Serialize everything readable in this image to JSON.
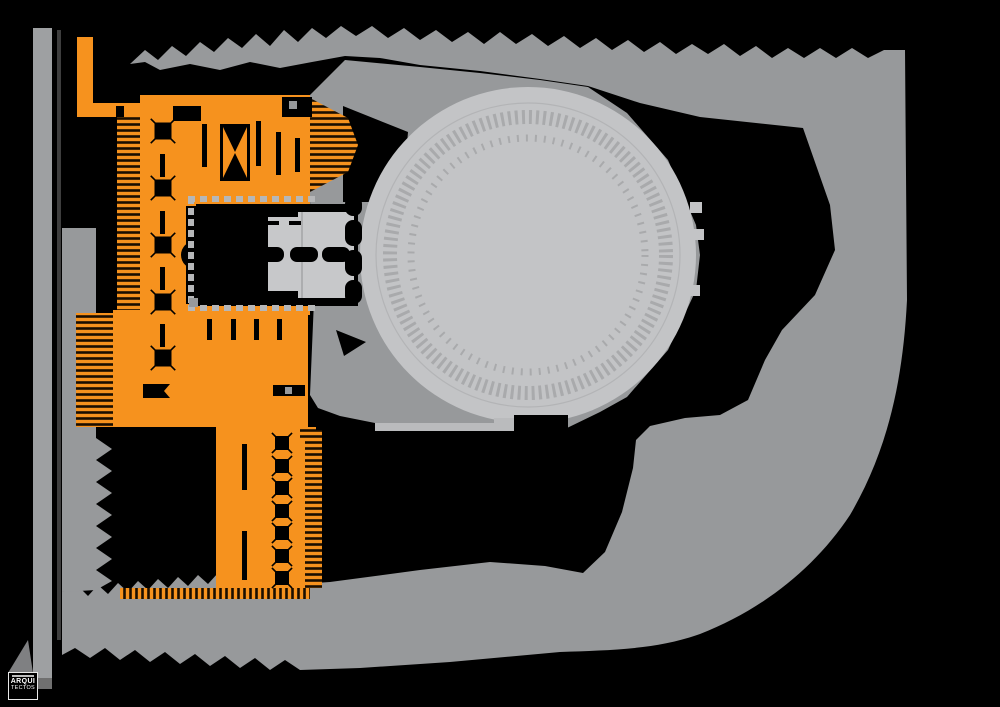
{
  "meta": {
    "drawing_type": "architectural-site-plan",
    "canvas": {
      "width": 1000,
      "height": 707
    }
  },
  "palette": {
    "background": "#000000",
    "plaza_gray": "#97999B",
    "road_gray": "#9EA0A2",
    "arena_light_gray": "#C3C4C6",
    "arena_detail_gray": "#A9AAAC",
    "hall_light_gray": "#C7C8CA",
    "walkway_light": "#BABBBD",
    "dash_gray": "#B6B7B9",
    "building_orange": "#F6921E",
    "ink_black": "#000000"
  },
  "logo": {
    "line1": "ARQUI",
    "line2": "TECTOS"
  },
  "regions": [
    {
      "name": "highlighted-building",
      "color": "#F6921E"
    },
    {
      "name": "circular-arena",
      "color": "#C3C4C6"
    },
    {
      "name": "public-plaza",
      "color": "#97999B"
    },
    {
      "name": "west-road",
      "color": "#9EA0A2"
    },
    {
      "name": "void",
      "color": "#000000"
    }
  ],
  "plan": {
    "shapes": [
      {
        "name": "background",
        "type": "rect",
        "x": 0,
        "y": 0,
        "w": 1000,
        "h": 707,
        "fill": "#000000"
      },
      {
        "name": "road-west",
        "type": "rect",
        "x": 33,
        "y": 28,
        "w": 19,
        "h": 650,
        "fill": "#9EA0A2"
      },
      {
        "name": "road-divider",
        "type": "rect",
        "x": 57,
        "y": 30,
        "w": 4,
        "h": 610,
        "fill": "#3E3E3E"
      },
      {
        "name": "road-end-cap",
        "type": "polygon",
        "points": "33,678 52,678 52,689 38,689",
        "fill": "#707070"
      },
      {
        "name": "plaza-band",
        "type": "path",
        "fill": "#97999B",
        "d": "M130,64 L145,50 L158,60 L172,46 L186,56 L200,42 L214,52 L228,38 L242,48 L256,34 L270,46 L284,30 L298,42 L312,28 L326,38 L341,26 L356,36 L372,26 L388,38 L404,28 L420,40 L436,30 L452,42 L468,32 L484,44 L500,32 L516,44 L532,34 L548,46 L564,36 L580,48 L596,38 L612,50 L628,40 L644,52 L660,42 L676,54 L692,44 L708,54 L724,44 L740,56 L756,46 L772,58 L788,48 L804,58 L820,48 L836,58 L852,48 L868,58 L884,50 L905,50 L907,300 C903,380 888,450 850,515 C815,568 762,610 700,634 C655,650 610,650 560,652 L450,662 L360,668 L300,670 L285,660 L270,670 L255,658 L240,668 L225,656 L210,666 L195,654 L180,664 L165,652 L150,662 L135,650 L120,660 L105,648 L90,658 L75,648 L62,655 L62,592 L80,588 L88,596 L98,585 L108,594 L118,583 L128,592 L138,581 L148,590 L158,579 L168,588 L178,577 L188,586 L198,575 L208,584 L218,573 L228,582 L238,571 L248,580 L258,569 L268,578 L278,569 L290,578 L300,584 L330,582 L420,570 L490,562 L545,566 L583,573 L605,552 L622,512 L633,468 L636,440 L650,426 L685,418 L720,415 L748,400 L765,360 L782,330 L815,295 L835,250 L830,205 L803,128 L700,117 L640,103 L588,86 L540,79 L480,71 L420,65 L380,58 L345,56 L312,62 L280,68 L250,62 L220,70 L190,64 L160,70 L145,62 Z"
      },
      {
        "name": "west-terrace-column",
        "type": "path",
        "fill": "#97999B",
        "d": "M62,228 L96,228 L96,438 L112,449 L96,460 L112,471 L96,482 L112,493 L96,504 L112,515 L96,526 L112,537 L96,548 L112,559 L96,570 L112,581 L96,590 L62,592 Z"
      },
      {
        "name": "arena-surround-plaza",
        "type": "path",
        "fill": "#97999B",
        "d": "M310,95 L345,60 L420,67 L480,73 L540,80 L588,87 L627,113 L668,160 L696,225 L700,255 L696,290 L668,350 L627,397 L600,412 L567,428 L513,428 L430,426 L380,424 L340,416 L318,408 L310,395 L314,300 L310,200 Z"
      },
      {
        "name": "south-walkway-strip",
        "type": "rect",
        "x": 375,
        "y": 423,
        "w": 140,
        "h": 8,
        "fill": "#BABBBD"
      },
      {
        "name": "void-wedge-west-of-arena",
        "type": "polygon",
        "points": "343,106 408,132 402,202 343,202",
        "fill": "#000000"
      },
      {
        "name": "circular-arena",
        "type": "circle",
        "cx": 528,
        "cy": 255,
        "r": 168,
        "fill": "#C3C4C6"
      },
      {
        "name": "arena-edge-ring",
        "type": "ring",
        "cx": 528,
        "cy": 255,
        "r": 152,
        "stroke": "#B3B4B6",
        "sw": 1.2,
        "dash": ""
      },
      {
        "name": "arena-seating-ring",
        "type": "ring",
        "cx": 528,
        "cy": 255,
        "r": 138,
        "stroke": "#A9AAAC",
        "sw": 14,
        "dash": "3 4"
      },
      {
        "name": "arena-inner-ring",
        "type": "ring",
        "cx": 528,
        "cy": 255,
        "r": 117,
        "stroke": "#A9AAAC",
        "sw": 7,
        "dash": "2 7"
      },
      {
        "name": "arena-east-nub-1",
        "type": "rect",
        "x": 690,
        "y": 202,
        "w": 12,
        "h": 11,
        "fill": "#C3C4C6"
      },
      {
        "name": "arena-east-nub-2",
        "type": "rect",
        "x": 692,
        "y": 229,
        "w": 12,
        "h": 11,
        "fill": "#C3C4C6"
      },
      {
        "name": "arena-east-nub-3",
        "type": "rect",
        "x": 688,
        "y": 285,
        "w": 12,
        "h": 11,
        "fill": "#C3C4C6"
      },
      {
        "name": "south-stage-block",
        "type": "rect",
        "x": 514,
        "y": 415,
        "w": 54,
        "h": 22,
        "fill": "#000000"
      },
      {
        "name": "south-stage-link",
        "type": "rect",
        "x": 494,
        "y": 418,
        "w": 20,
        "h": 7,
        "fill": "#BABBBD"
      },
      {
        "name": "building-nw-vertical-strip",
        "type": "rect",
        "x": 77,
        "y": 37,
        "w": 16,
        "h": 70,
        "fill": "#F6921E"
      },
      {
        "name": "building-nw-horizontal-strip",
        "type": "rect",
        "x": 77,
        "y": 103,
        "w": 83,
        "h": 14,
        "fill": "#F6921E"
      },
      {
        "name": "building-nw-notch",
        "type": "rect",
        "x": 116,
        "y": 106,
        "w": 8,
        "h": 11,
        "fill": "#000000"
      },
      {
        "name": "building-top-bar",
        "type": "rect",
        "x": 140,
        "y": 95,
        "w": 170,
        "h": 100,
        "fill": "#F6921E"
      },
      {
        "name": "building-spine",
        "type": "rect",
        "x": 140,
        "y": 95,
        "w": 46,
        "h": 332,
        "fill": "#F6921E"
      },
      {
        "name": "building-middle-bar",
        "type": "rect",
        "x": 113,
        "y": 310,
        "w": 195,
        "h": 117,
        "fill": "#F6921E"
      },
      {
        "name": "building-south-wing",
        "type": "rect",
        "x": 216,
        "y": 427,
        "w": 92,
        "h": 168,
        "fill": "#F6921E"
      },
      {
        "name": "courtyard-border-top",
        "type": "rect",
        "x": 186,
        "y": 195,
        "w": 124,
        "h": 11,
        "fill": "#F6921E"
      },
      {
        "name": "courtyard-border-bottom",
        "type": "rect",
        "x": 186,
        "y": 304,
        "w": 124,
        "h": 11,
        "fill": "#F6921E"
      },
      {
        "name": "hatch-spine-west",
        "type": "rect",
        "x": 117,
        "y": 117,
        "w": 23,
        "h": 193,
        "fill": "hatchH"
      },
      {
        "name": "hatch-terraces-west",
        "type": "rect",
        "x": 76,
        "y": 313,
        "w": 37,
        "h": 114,
        "fill": "hatchH"
      },
      {
        "name": "hatch-topbar-arrow",
        "type": "polygon",
        "points": "310,98 348,118 358,145 348,172 310,192",
        "fill": "hatchH"
      },
      {
        "name": "hatch-wing-east",
        "type": "rect",
        "x": 305,
        "y": 430,
        "w": 17,
        "h": 158,
        "fill": "hatchH"
      },
      {
        "name": "hatch-wing-south-fringe",
        "type": "rect",
        "x": 120,
        "y": 588,
        "w": 190,
        "h": 11,
        "fill": "hatchV"
      },
      {
        "name": "hatch-midbar-corner",
        "type": "rect",
        "x": 300,
        "y": 427,
        "w": 16,
        "h": 13,
        "fill": "hatchH"
      },
      {
        "name": "topbar-north-notch",
        "type": "rect",
        "x": 173,
        "y": 106,
        "w": 28,
        "h": 15,
        "fill": "#000000"
      },
      {
        "name": "topbar-north-block",
        "type": "rect",
        "x": 282,
        "y": 97,
        "w": 30,
        "h": 20,
        "fill": "#000000"
      },
      {
        "name": "topbar-north-block-window",
        "type": "rect",
        "x": 289,
        "y": 101,
        "w": 8,
        "h": 8,
        "fill": "#97999B"
      },
      {
        "name": "stair-core-frame",
        "type": "rect",
        "x": 220,
        "y": 124,
        "w": 30,
        "h": 57,
        "fill": "#000000"
      },
      {
        "name": "stair-core-inner",
        "type": "rect",
        "x": 223,
        "y": 127,
        "w": 24,
        "h": 51,
        "fill": "#F6921E"
      },
      {
        "name": "stair-core-flight-up",
        "type": "polygon",
        "points": "223,127 247,127 235,152",
        "fill": "#000000"
      },
      {
        "name": "stair-core-flight-down",
        "type": "polygon",
        "points": "223,178 247,178 235,153",
        "fill": "#000000"
      },
      {
        "name": "topbar-wall-slot-1",
        "type": "rect",
        "x": 202,
        "y": 124,
        "w": 5,
        "h": 43,
        "fill": "#000000"
      },
      {
        "name": "topbar-wall-slot-2",
        "type": "rect",
        "x": 256,
        "y": 121,
        "w": 5,
        "h": 45,
        "fill": "#000000"
      },
      {
        "name": "topbar-wall-slot-3",
        "type": "rect",
        "x": 276,
        "y": 132,
        "w": 5,
        "h": 43,
        "fill": "#000000"
      },
      {
        "name": "topbar-wall-slot-4",
        "type": "rect",
        "x": 295,
        "y": 138,
        "w": 5,
        "h": 34,
        "fill": "#000000"
      },
      {
        "name": "spine-column-row",
        "type": "xcolumn",
        "cx": 163,
        "cys": [
          131,
          188,
          245,
          302,
          358
        ],
        "s": 17,
        "fill": "#000000"
      },
      {
        "name": "spine-wall-slot-1",
        "type": "rect",
        "x": 160,
        "y": 154,
        "w": 5,
        "h": 23,
        "fill": "#000000"
      },
      {
        "name": "spine-wall-slot-2",
        "type": "rect",
        "x": 160,
        "y": 211,
        "w": 5,
        "h": 23,
        "fill": "#000000"
      },
      {
        "name": "spine-wall-slot-3",
        "type": "rect",
        "x": 160,
        "y": 267,
        "w": 5,
        "h": 23,
        "fill": "#000000"
      },
      {
        "name": "spine-wall-slot-4",
        "type": "rect",
        "x": 160,
        "y": 324,
        "w": 5,
        "h": 23,
        "fill": "#000000"
      },
      {
        "name": "courtyard-hall-void",
        "type": "rect",
        "x": 196,
        "y": 204,
        "w": 162,
        "h": 102,
        "fill": "#000000"
      },
      {
        "name": "courtyard-west-apse",
        "type": "circle",
        "cx": 195,
        "cy": 255,
        "r": 14,
        "fill": "#000000"
      },
      {
        "name": "foyer-hall",
        "type": "rect",
        "x": 268,
        "y": 212,
        "w": 86,
        "h": 86,
        "fill": "#C7C8CA"
      },
      {
        "name": "foyer-north-bar",
        "type": "rect",
        "x": 268,
        "y": 208,
        "w": 30,
        "h": 9,
        "fill": "#000000"
      },
      {
        "name": "foyer-south-bar",
        "type": "rect",
        "x": 268,
        "y": 291,
        "w": 30,
        "h": 9,
        "fill": "#000000"
      },
      {
        "name": "foyer-dash-1",
        "type": "rect",
        "x": 266,
        "y": 221,
        "w": 13,
        "h": 4,
        "fill": "#000000"
      },
      {
        "name": "foyer-dash-2",
        "type": "rect",
        "x": 289,
        "y": 221,
        "w": 13,
        "h": 4,
        "fill": "#000000"
      },
      {
        "name": "foyer-divider",
        "type": "rect",
        "x": 301,
        "y": 212,
        "w": 2,
        "h": 86,
        "fill": "#ACADAF"
      },
      {
        "name": "corridor-capsule-1",
        "type": "rect",
        "x": 244,
        "y": 247,
        "w": 40,
        "h": 15,
        "rx": 7,
        "fill": "#000000"
      },
      {
        "name": "corridor-capsule-2",
        "type": "rect",
        "x": 290,
        "y": 247,
        "w": 28,
        "h": 15,
        "rx": 7,
        "fill": "#000000"
      },
      {
        "name": "corridor-capsule-3",
        "type": "rect",
        "x": 322,
        "y": 247,
        "w": 28,
        "h": 15,
        "rx": 7,
        "fill": "#000000"
      },
      {
        "name": "arena-gate-pod-1",
        "type": "rect",
        "x": 345,
        "y": 196,
        "w": 17,
        "h": 20,
        "rx": 8,
        "fill": "#000000"
      },
      {
        "name": "arena-gate-pod-2",
        "type": "rect",
        "x": 345,
        "y": 220,
        "w": 17,
        "h": 26,
        "rx": 8,
        "fill": "#000000"
      },
      {
        "name": "arena-gate-pod-3",
        "type": "rect",
        "x": 345,
        "y": 250,
        "w": 17,
        "h": 26,
        "rx": 8,
        "fill": "#000000"
      },
      {
        "name": "arena-gate-pod-4",
        "type": "rect",
        "x": 345,
        "y": 280,
        "w": 17,
        "h": 24,
        "rx": 8,
        "fill": "#000000"
      },
      {
        "name": "void-wedge-sw-of-arena",
        "type": "polygon",
        "points": "336,330 366,342 344,356",
        "fill": "#000000"
      },
      {
        "name": "courtyard-dashes-west",
        "type": "dashrow",
        "x": 188,
        "y": 197,
        "dir": "y",
        "step": 11,
        "count": 10,
        "w": 6,
        "h": 7,
        "fill": "#B6B7B9"
      },
      {
        "name": "courtyard-dashes-north",
        "type": "dashrow",
        "x": 188,
        "y": 196,
        "dir": "x",
        "step": 12,
        "count": 11,
        "w": 7,
        "h": 6,
        "fill": "#B6B7B9"
      },
      {
        "name": "courtyard-dashes-south",
        "type": "dashrow",
        "x": 188,
        "y": 305,
        "dir": "x",
        "step": 12,
        "count": 11,
        "w": 7,
        "h": 6,
        "fill": "#B6B7B9"
      },
      {
        "name": "midbar-wall-slot-1",
        "type": "rect",
        "x": 207,
        "y": 319,
        "w": 5,
        "h": 21,
        "fill": "#000000"
      },
      {
        "name": "midbar-wall-slot-2",
        "type": "rect",
        "x": 231,
        "y": 319,
        "w": 5,
        "h": 21,
        "fill": "#000000"
      },
      {
        "name": "midbar-wall-slot-3",
        "type": "rect",
        "x": 254,
        "y": 319,
        "w": 5,
        "h": 21,
        "fill": "#000000"
      },
      {
        "name": "midbar-wall-slot-4",
        "type": "rect",
        "x": 277,
        "y": 319,
        "w": 5,
        "h": 21,
        "fill": "#000000"
      },
      {
        "name": "midbar-gray-corner",
        "type": "rect",
        "x": 189,
        "y": 298,
        "w": 9,
        "h": 9,
        "fill": "#97999B"
      },
      {
        "name": "midbar-room-west",
        "type": "polygon",
        "points": "143,384 170,384 164,391 170,398 143,398",
        "fill": "#000000"
      },
      {
        "name": "midbar-room-east",
        "type": "rect",
        "x": 273,
        "y": 385,
        "w": 32,
        "h": 11,
        "fill": "#000000"
      },
      {
        "name": "midbar-room-east-window",
        "type": "rect",
        "x": 285,
        "y": 387,
        "w": 7,
        "h": 7,
        "fill": "#97999B"
      },
      {
        "name": "midbar-south-bar",
        "type": "rect",
        "x": 122,
        "y": 428,
        "w": 90,
        "h": 11,
        "fill": "#000000"
      },
      {
        "name": "wing-column-row",
        "type": "xcolumn",
        "cx": 282,
        "cys": [
          443,
          466,
          488,
          511,
          533,
          556,
          578
        ],
        "s": 14,
        "fill": "#000000"
      },
      {
        "name": "wing-wall-slot-1",
        "type": "rect",
        "x": 242,
        "y": 444,
        "w": 5,
        "h": 46,
        "fill": "#000000"
      },
      {
        "name": "wing-wall-slot-2",
        "type": "rect",
        "x": 242,
        "y": 531,
        "w": 5,
        "h": 49,
        "fill": "#000000"
      },
      {
        "name": "logo-backdrop-triangle",
        "type": "polygon",
        "points": "28,640 33,673 8,673",
        "fill": "#7F8082"
      }
    ]
  }
}
